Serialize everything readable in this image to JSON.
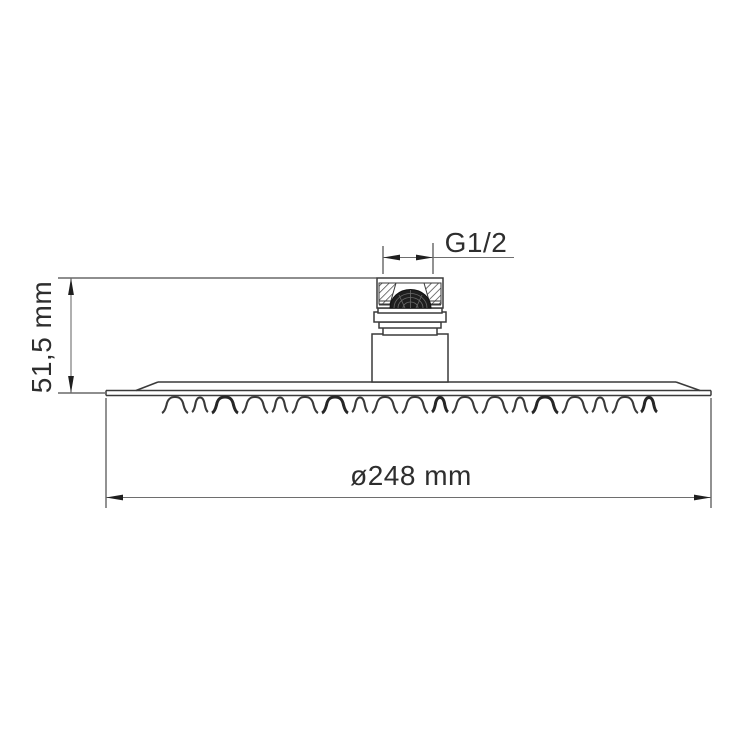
{
  "drawing": {
    "background_color": "#ffffff",
    "line_color": "#3a3a3a",
    "dimension_line_color": "#6e6e6e",
    "text_color": "#2e2e2e",
    "dimensions": {
      "thread": {
        "label": "G1/2"
      },
      "height": {
        "label": "51,5 mm"
      },
      "diameter": {
        "label": "ø248 mm"
      }
    }
  }
}
